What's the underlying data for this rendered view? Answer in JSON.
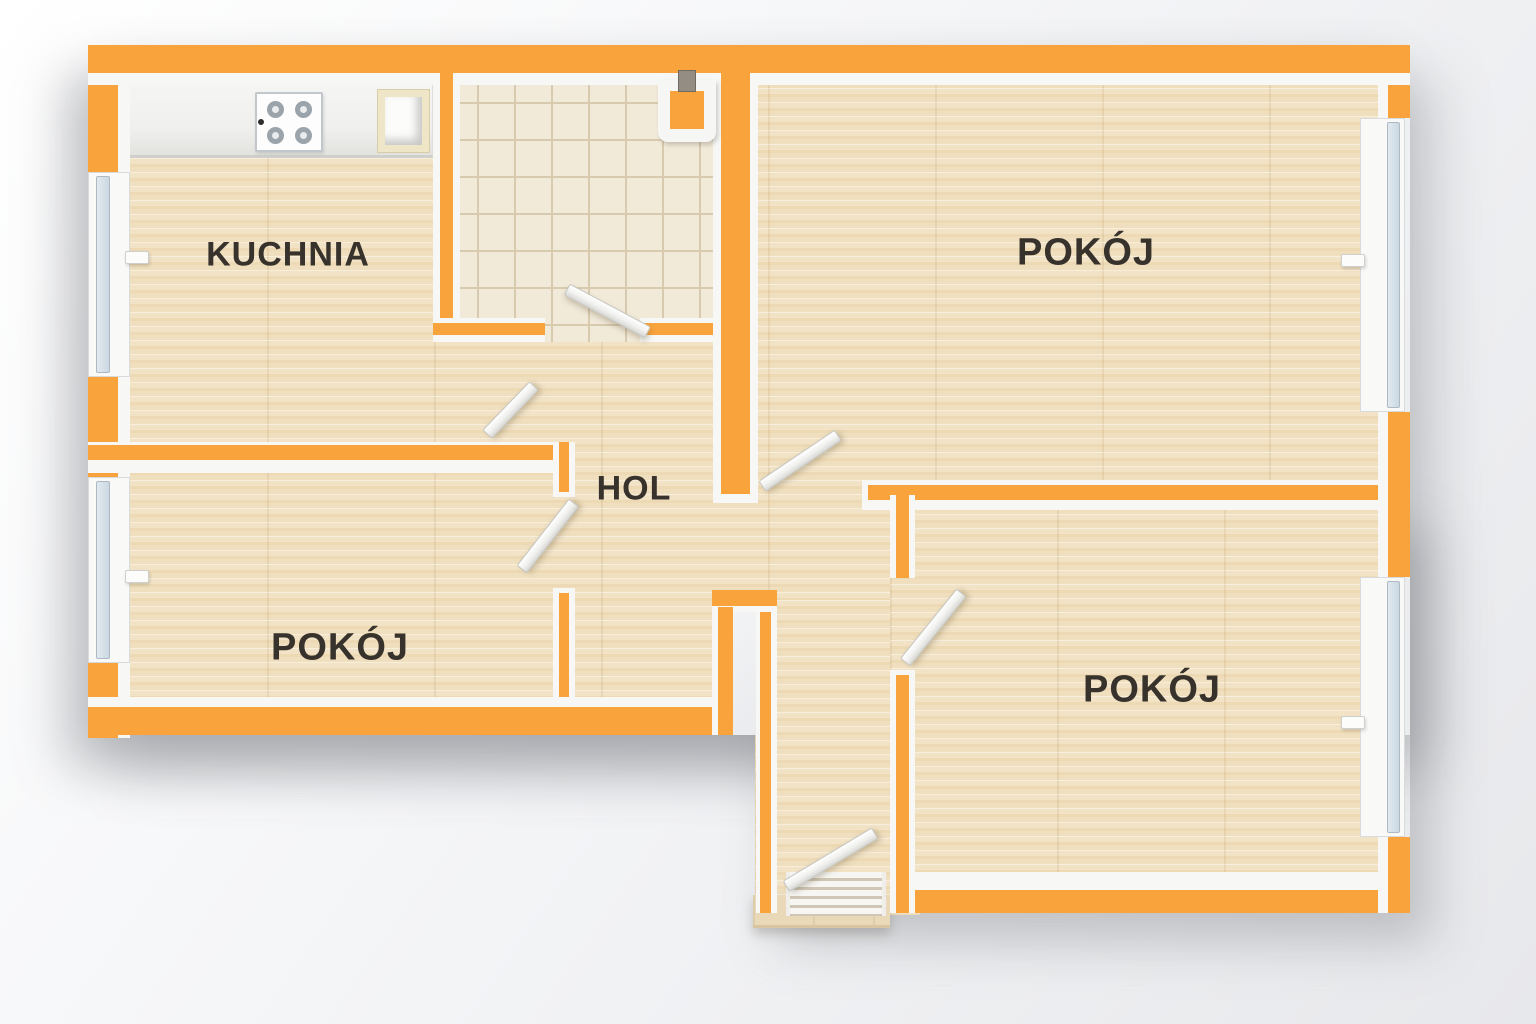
{
  "labels": {
    "kitchen": "KUCHNIA",
    "room_top_right": "POKÓJ",
    "hall": "HOL",
    "room_bottom_left": "POKÓJ",
    "room_bottom_right": "POKÓJ"
  },
  "colors": {
    "wall_orange": "#F8A33C",
    "wood_floor": "#F0DFBF",
    "wood_floor_dark": "#EDDAB5",
    "tile_floor": "#F2EAD9",
    "tile_line": "#D8CAAE",
    "window_glass": "#CBD8E2",
    "label_text": "#37322B",
    "background_top": "#FFFFFF",
    "background_bottom": "#E7E8EB"
  }
}
